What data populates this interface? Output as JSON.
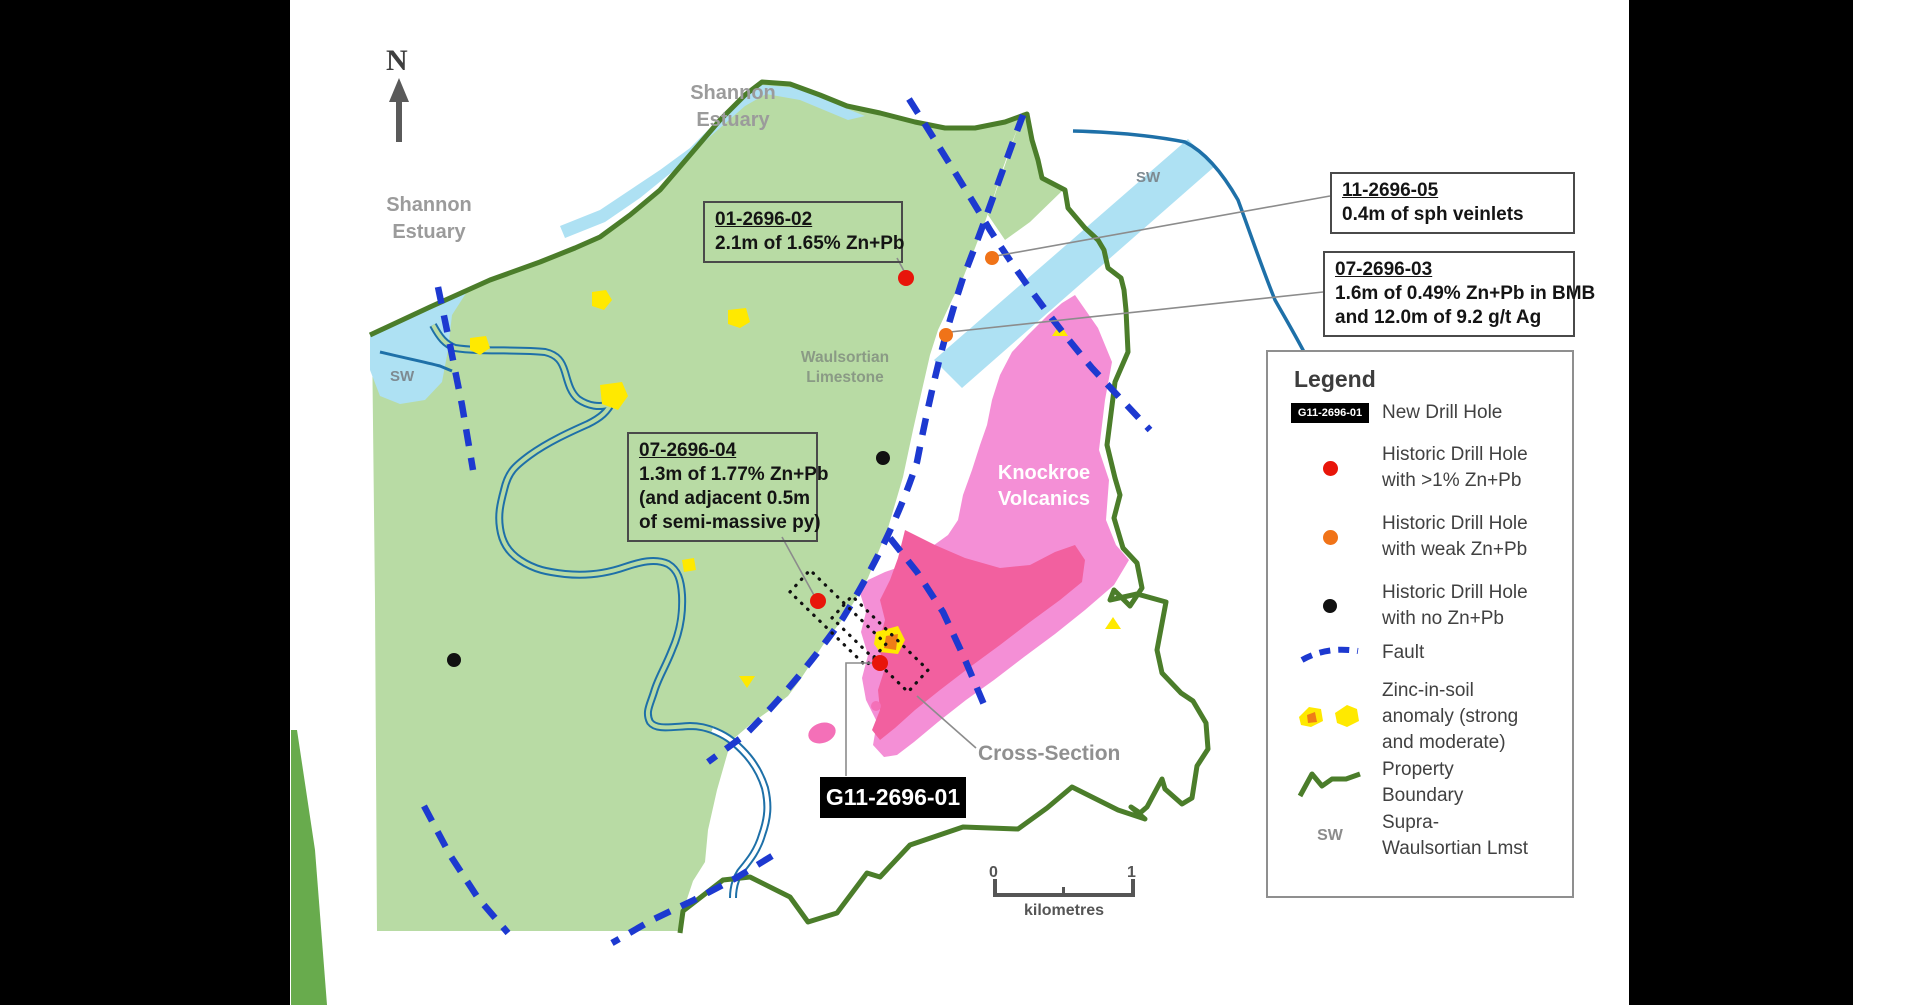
{
  "map": {
    "north_label": "N",
    "labels": {
      "shannon_estuary_top": {
        "line1": "Shannon",
        "line2": "Estuary"
      },
      "shannon_estuary_left": {
        "line1": "Shannon",
        "line2": "Estuary"
      },
      "sw_left": "SW",
      "sw_right": "SW",
      "waulsortian": {
        "line1": "Waulsortian",
        "line2": "Limestone"
      },
      "knockroe": {
        "line1": "Knockroe",
        "line2": "Volcanics"
      },
      "cross_section": "Cross-Section"
    },
    "callouts": [
      {
        "id": "01-2696-02",
        "lines": [
          "2.1m of 1.65% Zn+Pb"
        ]
      },
      {
        "id": "11-2696-05",
        "lines": [
          "0.4m of sph veinlets"
        ]
      },
      {
        "id": "07-2696-03",
        "lines": [
          "1.6m of 0.49% Zn+Pb in BMB",
          "and 12.0m of 9.2 g/t Ag"
        ]
      },
      {
        "id": "07-2696-04",
        "lines": [
          "1.3m of 1.77% Zn+Pb",
          "(and adjacent 0.5m",
          "of semi-massive py)"
        ]
      }
    ],
    "new_drill_hole_label": "G11-2696-01",
    "scale": {
      "start": "0",
      "end": "1",
      "unit": "kilometres"
    }
  },
  "legend": {
    "title": "Legend",
    "items": [
      {
        "symbol": "new-drill-hole-chip",
        "symbol_text": "G11-2696-01",
        "lines": [
          "New Drill Hole"
        ]
      },
      {
        "symbol": "red-dot",
        "lines": [
          "Historic Drill Hole",
          "with >1% Zn+Pb"
        ]
      },
      {
        "symbol": "orange-dot",
        "lines": [
          "Historic Drill Hole",
          "with weak Zn+Pb"
        ]
      },
      {
        "symbol": "black-dot",
        "lines": [
          "Historic Drill Hole",
          "with no Zn+Pb"
        ]
      },
      {
        "symbol": "fault-dashed-line",
        "lines": [
          "Fault"
        ]
      },
      {
        "symbol": "zinc-anomaly-blobs",
        "lines": [
          "Zinc-in-soil",
          "anomaly (strong",
          "and moderate)"
        ]
      },
      {
        "symbol": "property-boundary-zigzag",
        "lines": [
          "Property",
          "Boundary"
        ]
      },
      {
        "symbol": "sw-text",
        "symbol_text": "SW",
        "lines": [
          "Supra-",
          "Waulsortian Lmst"
        ]
      }
    ]
  },
  "colors": {
    "limestone_fill": "#b8dba4",
    "property_boundary": "#4b7d2a",
    "boundary_wedge": "#68ab4d",
    "estuary_fill": "#aee1f3",
    "river_blue": "#1e70a8",
    "fault_blue": "#1d39d0",
    "volcanics_pink": "#f48fd6",
    "volcanics_core_pink": "#f2609f",
    "anomaly_yellow": "#ffe900",
    "anomaly_orange_core": "#ef7d17",
    "drill_red": "#e8150a",
    "drill_orange": "#f07318",
    "drill_black": "#111111"
  }
}
